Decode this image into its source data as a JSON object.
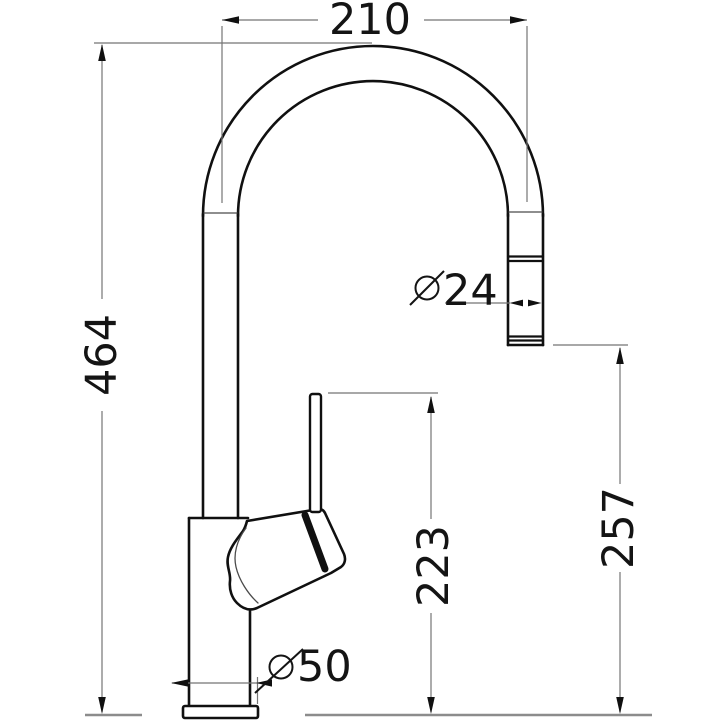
{
  "drawing": {
    "type": "technical-dimension-drawing",
    "subject": "kitchen-mixer-tap-side-view"
  },
  "dimensions": {
    "spout_width": {
      "value": "210"
    },
    "overall_height": {
      "value": "464"
    },
    "spout_diameter": {
      "symbol": "⌀",
      "value": "24"
    },
    "outlet_height": {
      "value": "257"
    },
    "handle_height": {
      "value": "223"
    },
    "base_diameter": {
      "symbol": "⌀",
      "value": "50"
    }
  },
  "icons": {
    "diameter_symbol": "⌀"
  },
  "colors": {
    "outline": "#101010",
    "dimension_line": "#757575",
    "arrowhead": "#101010",
    "ground_line": "#8c8c8c",
    "background": "#ffffff",
    "text": "#141414"
  }
}
